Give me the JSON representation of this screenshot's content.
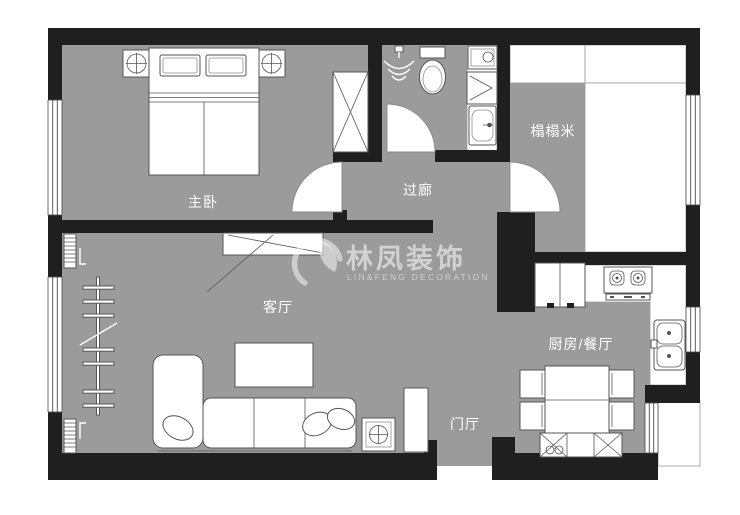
{
  "title": "apartment-floor-plan",
  "colors": {
    "floor_gray": "#9b9b9b",
    "wall_black": "#1f1f1f",
    "furniture_line": "#555555",
    "label_text": "#ffffff",
    "watermark": "rgba(255,255,255,0.55)"
  },
  "rooms": [
    {
      "id": "master-bedroom",
      "label": "主卧"
    },
    {
      "id": "corridor",
      "label": "过廊"
    },
    {
      "id": "tatami-room",
      "label": "榻榻米"
    },
    {
      "id": "living-room",
      "label": "客厅"
    },
    {
      "id": "kitchen-dining",
      "label": "厨房/餐厅"
    },
    {
      "id": "entry-hall",
      "label": "门厅"
    }
  ],
  "watermark": {
    "brand": "林凤装饰",
    "subtitle": "LIN&FENG DECORATION"
  }
}
